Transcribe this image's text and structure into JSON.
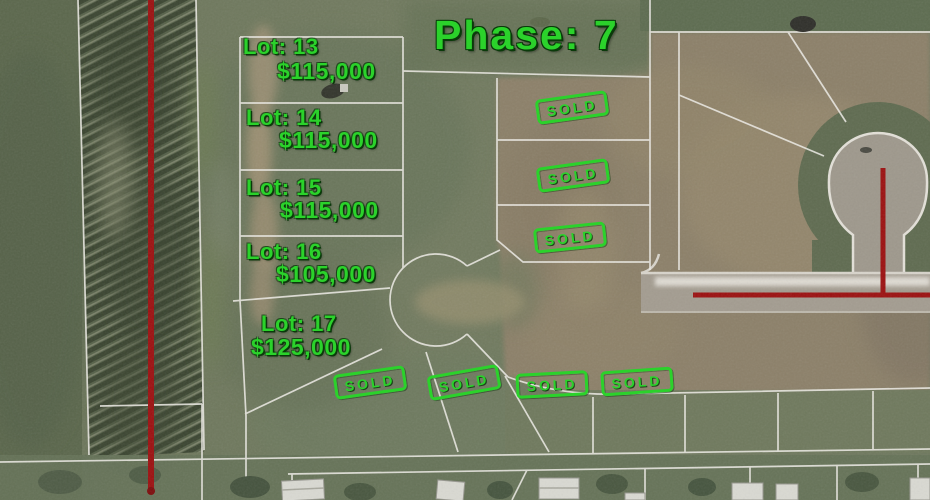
{
  "title": "Phase: 7",
  "lots": [
    {
      "label": "Lot: 13",
      "price": "$115,000"
    },
    {
      "label": "Lot: 14",
      "price": "$115,000"
    },
    {
      "label": "Lot: 15",
      "price": "$115,000"
    },
    {
      "label": "Lot: 16",
      "price": "$105,000"
    },
    {
      "label": "Lot: 17",
      "price": "$125,000"
    }
  ],
  "stamps": [
    {
      "label": "SOLD"
    },
    {
      "label": "SOLD"
    },
    {
      "label": "SOLD"
    },
    {
      "label": "SOLD"
    },
    {
      "label": "SOLD"
    },
    {
      "label": "SOLD"
    },
    {
      "label": "SOLD"
    }
  ],
  "colors": {
    "annotation_green": "#2bd22b",
    "boundary_red": "#9c1111",
    "survey_line_white": "#eceae4"
  }
}
